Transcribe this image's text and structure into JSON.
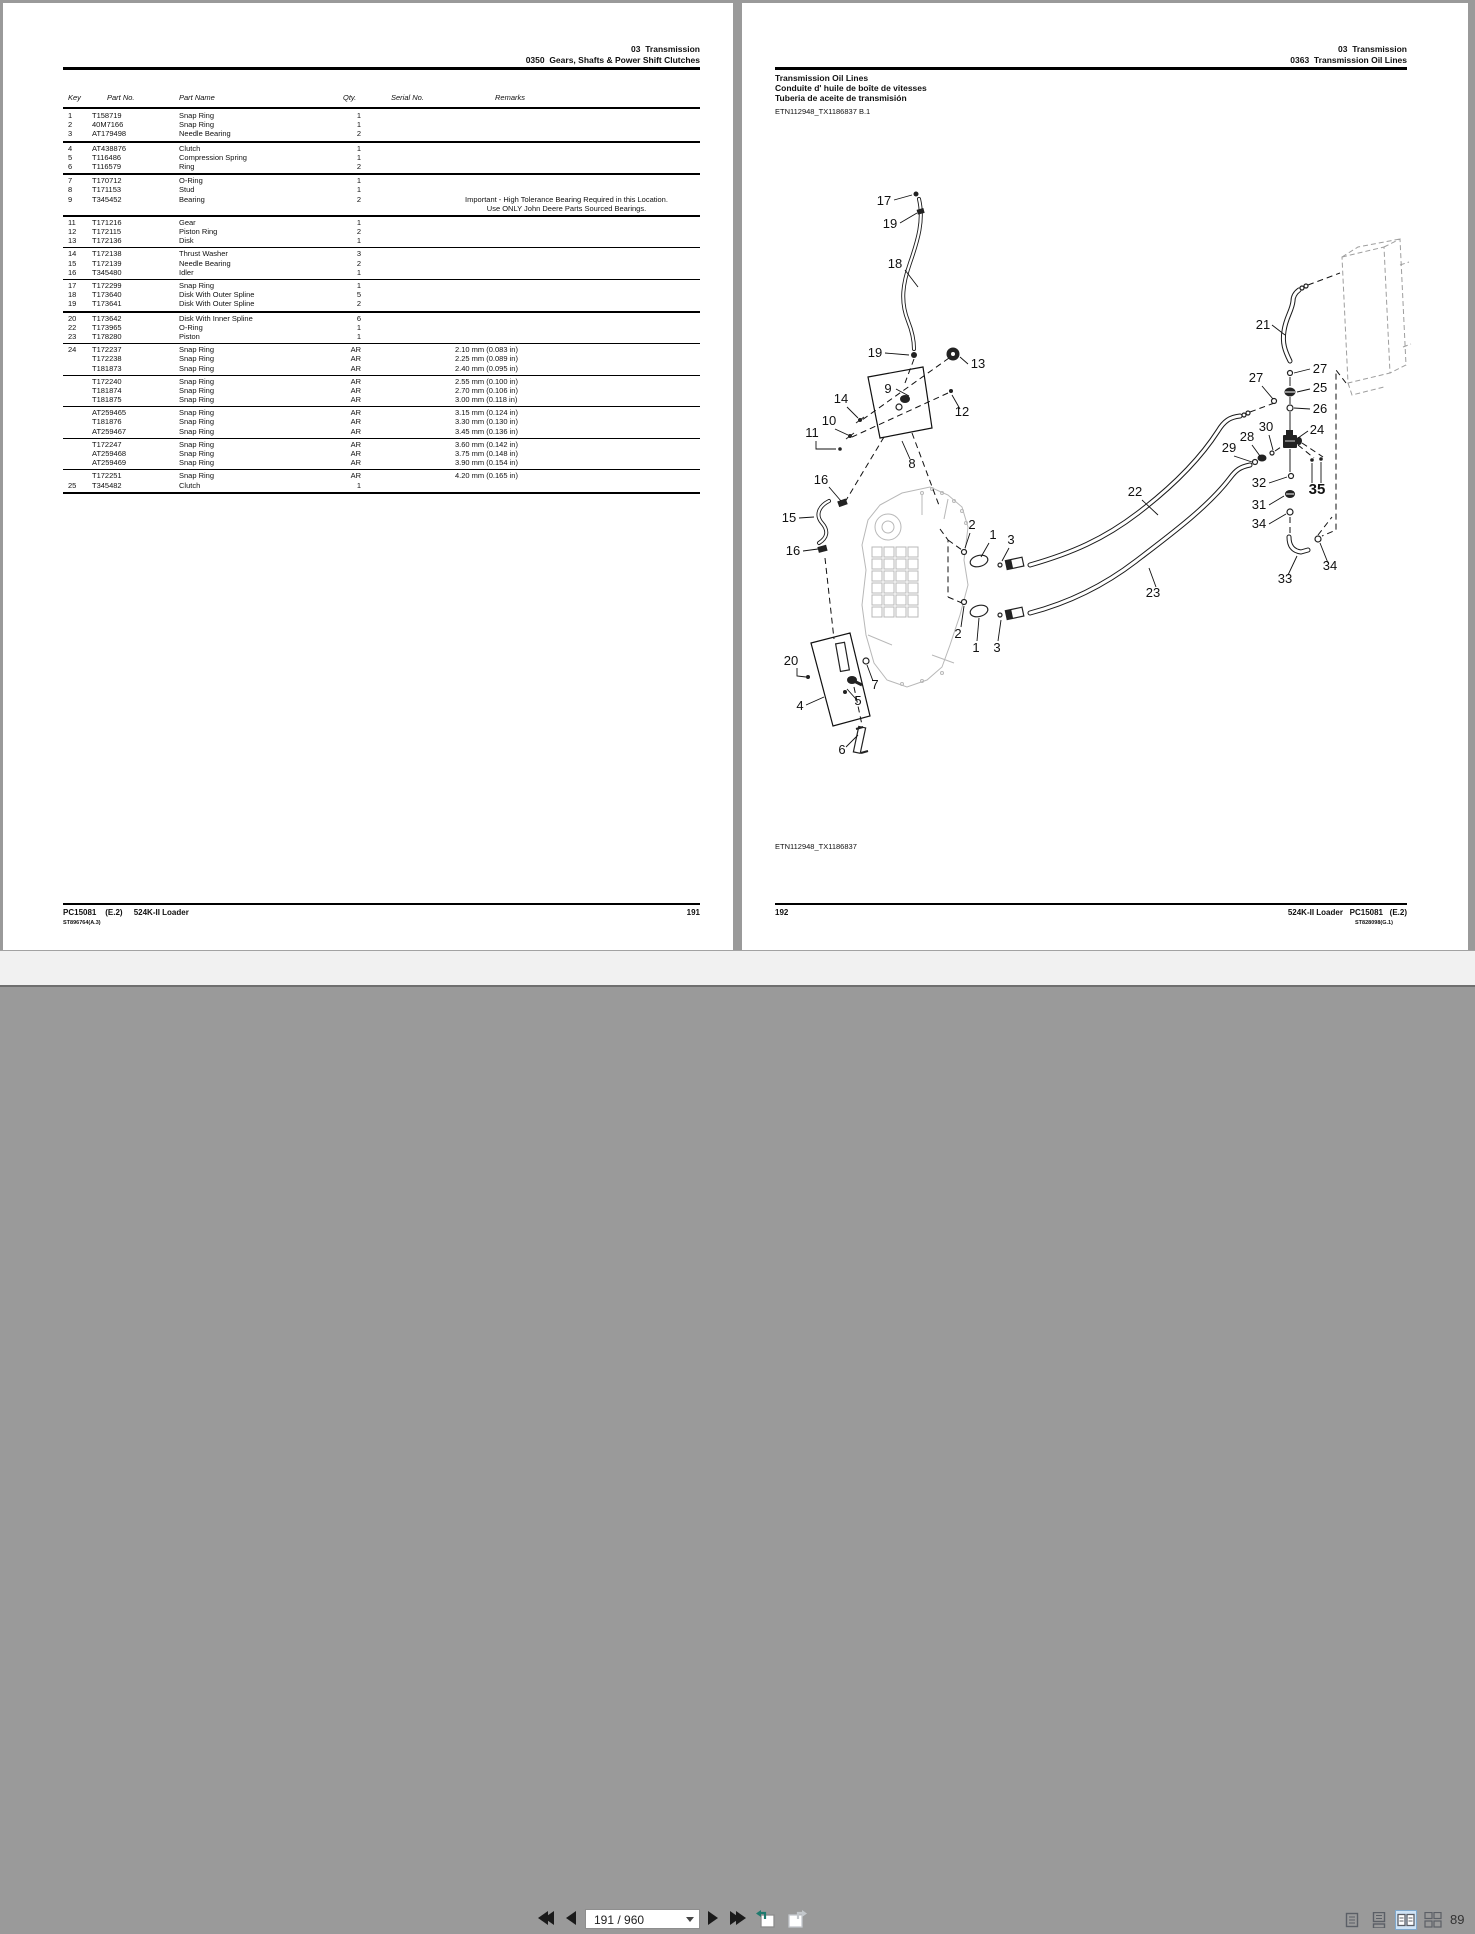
{
  "left_page": {
    "header": {
      "line1": "03  Transmission",
      "line2": "0350  Gears, Shafts & Power Shift Clutches"
    },
    "columns": {
      "key": "Key",
      "part_no": "Part No.",
      "part_name": "Part Name",
      "qty": "Qty.",
      "serial_no": "Serial No.",
      "remarks": "Remarks"
    },
    "groups": [
      {
        "thick": true,
        "rows": [
          {
            "key": "1",
            "part_no": "T158719",
            "part_name": "Snap Ring",
            "qty": "1"
          },
          {
            "key": "2",
            "part_no": "40M7166",
            "part_name": "Snap Ring",
            "qty": "1"
          },
          {
            "key": "3",
            "part_no": "AT179498",
            "part_name": "Needle Bearing",
            "qty": "2"
          }
        ]
      },
      {
        "thick": true,
        "rows": [
          {
            "key": "4",
            "part_no": "AT438876",
            "part_name": "Clutch",
            "qty": "1"
          },
          {
            "key": "5",
            "part_no": "T116486",
            "part_name": "Compression Spring",
            "qty": "1"
          },
          {
            "key": "6",
            "part_no": "T116579",
            "part_name": "Ring",
            "qty": "2"
          }
        ]
      },
      {
        "thick": true,
        "rows": [
          {
            "key": "7",
            "part_no": "T170712",
            "part_name": "O-Ring",
            "qty": "1"
          },
          {
            "key": "8",
            "part_no": "T171153",
            "part_name": "Stud",
            "qty": "1"
          },
          {
            "key": "9",
            "part_no": "T345452",
            "part_name": "Bearing",
            "qty": "2",
            "remark_lines": [
              "Important - High Tolerance Bearing Required in this Location.",
              "Use ONLY John Deere Parts Sourced Bearings."
            ]
          }
        ]
      },
      {
        "thick": false,
        "rows": [
          {
            "key": "11",
            "part_no": "T171216",
            "part_name": "Gear",
            "qty": "1"
          },
          {
            "key": "12",
            "part_no": "T172115",
            "part_name": "Piston Ring",
            "qty": "2"
          },
          {
            "key": "13",
            "part_no": "T172136",
            "part_name": "Disk",
            "qty": "1"
          }
        ]
      },
      {
        "thick": false,
        "rows": [
          {
            "key": "14",
            "part_no": "T172138",
            "part_name": "Thrust Washer",
            "qty": "3"
          },
          {
            "key": "15",
            "part_no": "T172139",
            "part_name": "Needle Bearing",
            "qty": "2"
          },
          {
            "key": "16",
            "part_no": "T345480",
            "part_name": "Idler",
            "qty": "1"
          }
        ]
      },
      {
        "thick": true,
        "rows": [
          {
            "key": "17",
            "part_no": "T172299",
            "part_name": "Snap Ring",
            "qty": "1"
          },
          {
            "key": "18",
            "part_no": "T173640",
            "part_name": "Disk With Outer Spline",
            "qty": "5"
          },
          {
            "key": "19",
            "part_no": "T173641",
            "part_name": "Disk With Outer Spline",
            "qty": "2"
          }
        ]
      },
      {
        "thick": false,
        "rows": [
          {
            "key": "20",
            "part_no": "T173642",
            "part_name": "Disk With Inner Spline",
            "qty": "6"
          },
          {
            "key": "22",
            "part_no": "T173965",
            "part_name": "O-Ring",
            "qty": "1"
          },
          {
            "key": "23",
            "part_no": "T178280",
            "part_name": "Piston",
            "qty": "1"
          }
        ]
      },
      {
        "thick": false,
        "rows": [
          {
            "key": "24",
            "part_no": "T172237",
            "part_name": "Snap Ring",
            "qty": "AR",
            "remark": "2.10 mm (0.083 in)"
          },
          {
            "key": "",
            "part_no": "T172238",
            "part_name": "Snap Ring",
            "qty": "AR",
            "remark": "2.25 mm (0.089 in)"
          },
          {
            "key": "",
            "part_no": "T181873",
            "part_name": "Snap Ring",
            "qty": "AR",
            "remark": "2.40 mm (0.095 in)"
          }
        ]
      },
      {
        "thick": false,
        "rows": [
          {
            "key": "",
            "part_no": "T172240",
            "part_name": "Snap Ring",
            "qty": "AR",
            "remark": "2.55 mm (0.100 in)"
          },
          {
            "key": "",
            "part_no": "T181874",
            "part_name": "Snap Ring",
            "qty": "AR",
            "remark": "2.70 mm (0.106 in)"
          },
          {
            "key": "",
            "part_no": "T181875",
            "part_name": "Snap Ring",
            "qty": "AR",
            "remark": "3.00 mm (0.118 in)"
          }
        ]
      },
      {
        "thick": false,
        "rows": [
          {
            "key": "",
            "part_no": "AT259465",
            "part_name": "Snap Ring",
            "qty": "AR",
            "remark": "3.15 mm (0.124 in)"
          },
          {
            "key": "",
            "part_no": "T181876",
            "part_name": "Snap Ring",
            "qty": "AR",
            "remark": "3.30 mm (0.130 in)"
          },
          {
            "key": "",
            "part_no": "AT259467",
            "part_name": "Snap Ring",
            "qty": "AR",
            "remark": "3.45 mm (0.136 in)"
          }
        ]
      },
      {
        "thick": false,
        "rows": [
          {
            "key": "",
            "part_no": "T172247",
            "part_name": "Snap Ring",
            "qty": "AR",
            "remark": "3.60 mm (0.142 in)"
          },
          {
            "key": "",
            "part_no": "AT259468",
            "part_name": "Snap Ring",
            "qty": "AR",
            "remark": "3.75 mm (0.148 in)"
          },
          {
            "key": "",
            "part_no": "AT259469",
            "part_name": "Snap Ring",
            "qty": "AR",
            "remark": "3.90 mm (0.154 in)"
          }
        ]
      },
      {
        "thick": true,
        "rows": [
          {
            "key": "",
            "part_no": "T172251",
            "part_name": "Snap Ring",
            "qty": "AR",
            "remark": "4.20 mm (0.165 in)"
          },
          {
            "key": "25",
            "part_no": "T345482",
            "part_name": "Clutch",
            "qty": "1"
          }
        ]
      }
    ],
    "footer": {
      "left": "PC15081    (E.2)     524K-II Loader",
      "page": "191",
      "sub": "ST896764(A.3)"
    }
  },
  "right_page": {
    "header": {
      "line1": "03  Transmission",
      "line2": "0363  Transmission Oil Lines"
    },
    "title_lines": {
      "l1": "Transmission Oil Lines",
      "l2": "Conduite d' huile de boîte de vitesses",
      "l3": "Tuberia de aceite de transmisión"
    },
    "figure_ref_top": "ETN112948_TX1186837 B.1",
    "figure_ref_bottom": "ETN112948_TX1186837",
    "footer": {
      "page": "192",
      "right": "524K-II Loader   PC15081   (E.2)",
      "sub": "ST828098(G.1)"
    },
    "callouts": [
      {
        "t": "17",
        "x": 112,
        "y": 90
      },
      {
        "t": "19",
        "x": 118,
        "y": 113
      },
      {
        "t": "18",
        "x": 123,
        "y": 153
      },
      {
        "t": "19",
        "x": 103,
        "y": 242
      },
      {
        "t": "13",
        "x": 206,
        "y": 253
      },
      {
        "t": "9",
        "x": 116,
        "y": 278
      },
      {
        "t": "14",
        "x": 69,
        "y": 288
      },
      {
        "t": "12",
        "x": 190,
        "y": 301
      },
      {
        "t": "10",
        "x": 57,
        "y": 310
      },
      {
        "t": "11",
        "x": 40,
        "y": 322
      },
      {
        "t": "8",
        "x": 140,
        "y": 353
      },
      {
        "t": "16",
        "x": 49,
        "y": 369
      },
      {
        "t": "15",
        "x": 17,
        "y": 407
      },
      {
        "t": "16",
        "x": 21,
        "y": 440
      },
      {
        "t": "20",
        "x": 19,
        "y": 550
      },
      {
        "t": "4",
        "x": 28,
        "y": 595
      },
      {
        "t": "5",
        "x": 86,
        "y": 590
      },
      {
        "t": "7",
        "x": 103,
        "y": 574
      },
      {
        "t": "6",
        "x": 70,
        "y": 639
      },
      {
        "t": "2",
        "x": 200,
        "y": 414
      },
      {
        "t": "1",
        "x": 221,
        "y": 424
      },
      {
        "t": "3",
        "x": 239,
        "y": 429
      },
      {
        "t": "2",
        "x": 186,
        "y": 523
      },
      {
        "t": "1",
        "x": 204,
        "y": 537
      },
      {
        "t": "3",
        "x": 225,
        "y": 537
      },
      {
        "t": "22",
        "x": 363,
        "y": 381
      },
      {
        "t": "23",
        "x": 381,
        "y": 482
      },
      {
        "t": "21",
        "x": 491,
        "y": 214
      },
      {
        "t": "27",
        "x": 484,
        "y": 267
      },
      {
        "t": "27",
        "x": 548,
        "y": 258
      },
      {
        "t": "25",
        "x": 548,
        "y": 277
      },
      {
        "t": "26",
        "x": 548,
        "y": 298
      },
      {
        "t": "30",
        "x": 494,
        "y": 316
      },
      {
        "t": "24",
        "x": 545,
        "y": 319
      },
      {
        "t": "28",
        "x": 475,
        "y": 326
      },
      {
        "t": "29",
        "x": 457,
        "y": 337
      },
      {
        "t": "32",
        "x": 487,
        "y": 372
      },
      {
        "t": "35",
        "x": 545,
        "y": 379,
        "bold": true
      },
      {
        "t": "31",
        "x": 487,
        "y": 394
      },
      {
        "t": "34",
        "x": 487,
        "y": 413
      },
      {
        "t": "33",
        "x": 513,
        "y": 468
      },
      {
        "t": "34",
        "x": 558,
        "y": 455
      }
    ]
  },
  "toolbar": {
    "page_field": "191 / 960",
    "zoom_level": "89",
    "icons": {
      "first_page": "first-page",
      "prev_page": "previous-page",
      "next_page": "next-page",
      "last_page": "last-page",
      "prev_view": "previous-view",
      "next_view": "next-view",
      "layout_single": "single-page-view",
      "layout_continuous": "continuous-view",
      "layout_two_up": "two-page-view",
      "layout_two_up_continuous": "two-page-continuous-view"
    },
    "colors": {
      "selected_bg": "#cfe3f5",
      "selected_border": "#7fa8cc",
      "accent_teal": "#1f7a6e"
    }
  }
}
